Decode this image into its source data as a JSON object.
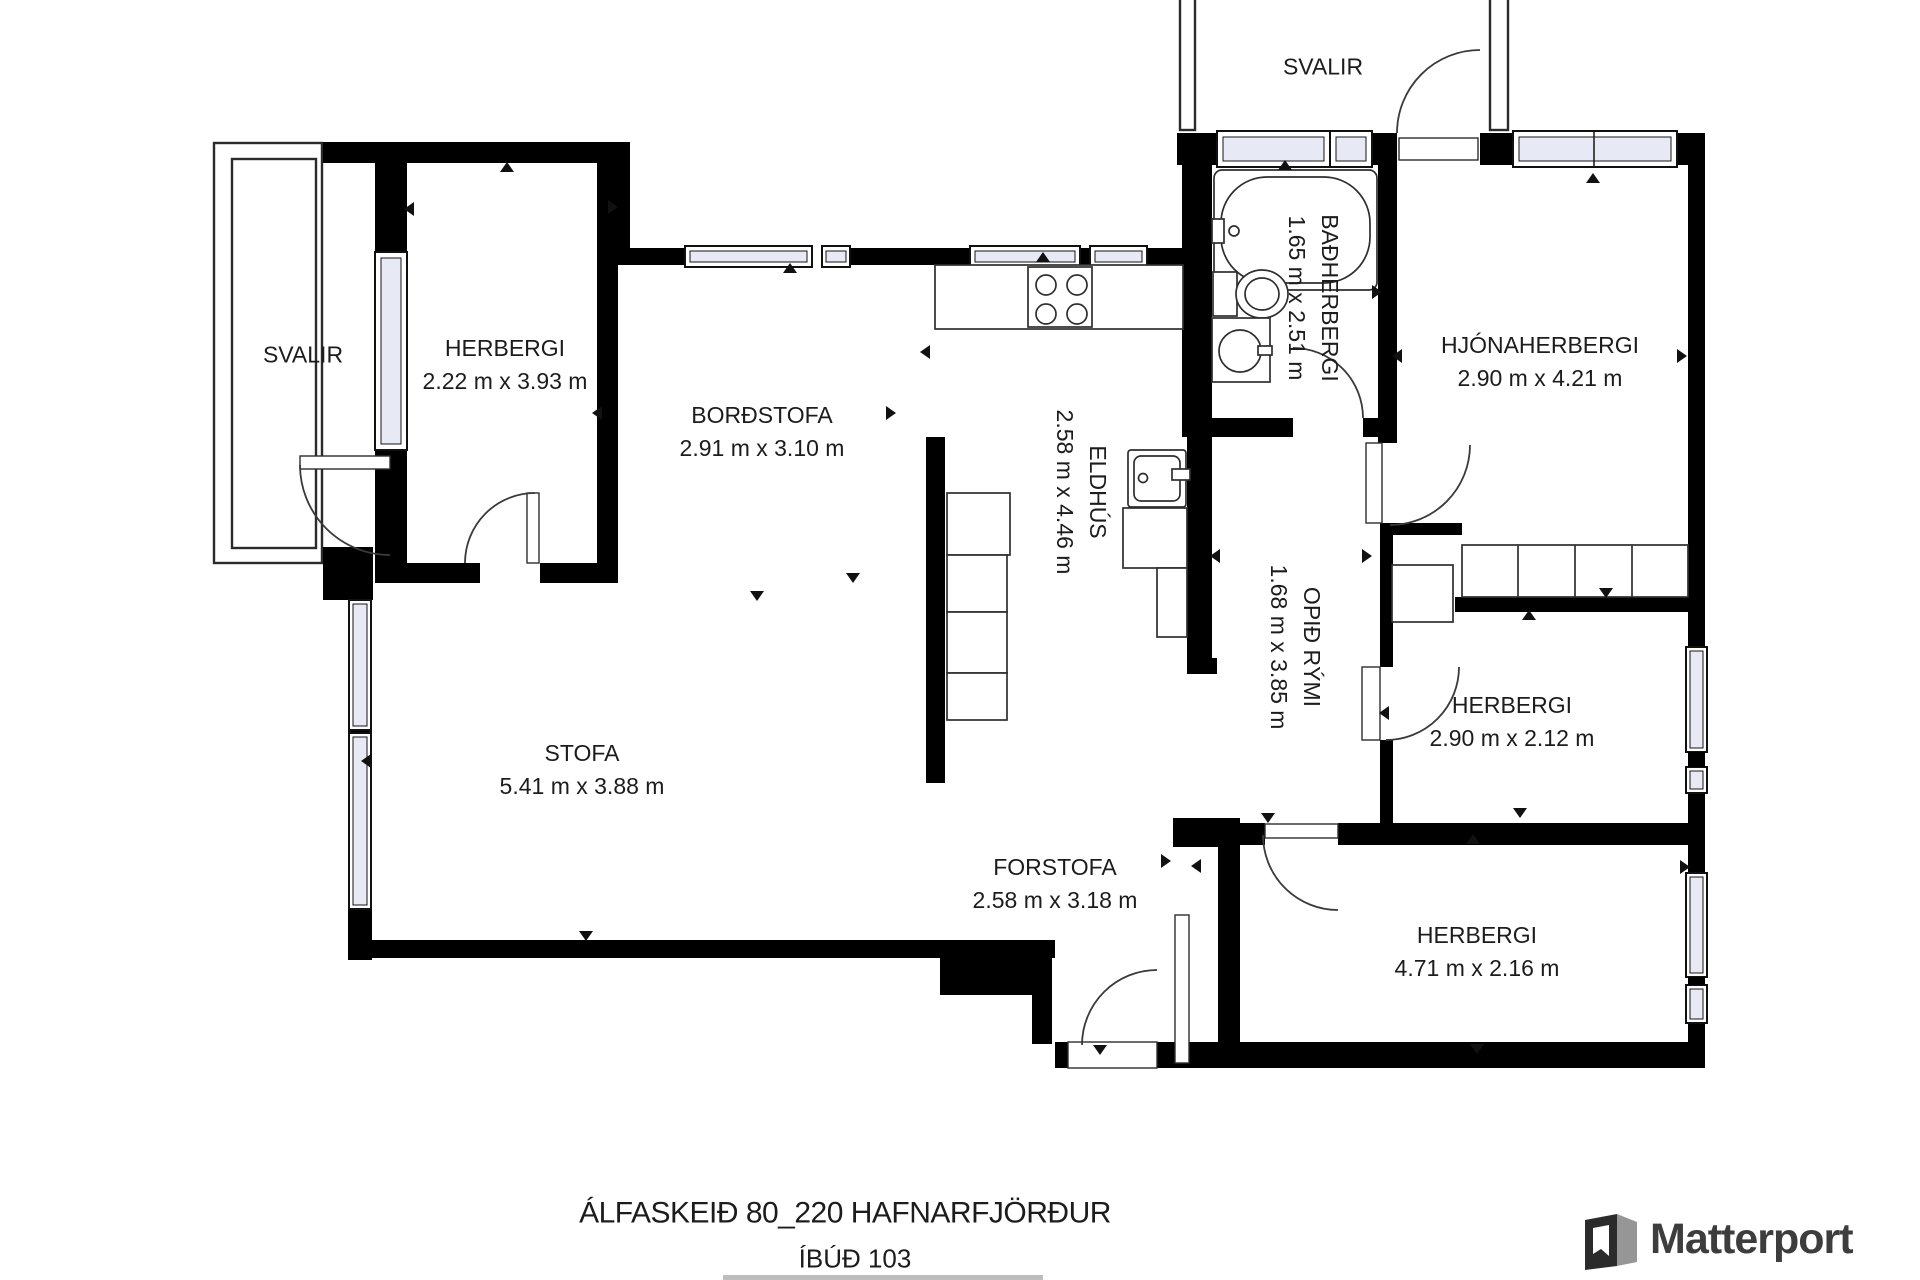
{
  "plan": {
    "address_line": "ÁLFASKEIÐ 80_220 HAFNARFJÖRÐUR",
    "unit_line": "ÍBÚÐ 103"
  },
  "branding": {
    "logo_text": "Matterport"
  },
  "rooms": {
    "svalir_top": {
      "name": "SVALIR"
    },
    "svalir_left": {
      "name": "SVALIR"
    },
    "herbergi_nw": {
      "name": "HERBERGI",
      "dims": "2.22 m x 3.93 m"
    },
    "bordstofa": {
      "name": "BORÐSTOFA",
      "dims": "2.91 m x 3.10 m"
    },
    "eldhus": {
      "name": "ELDHÚS",
      "dims": "2.58 m x 4.46 m"
    },
    "badherbergi": {
      "name": "BAÐHERBERGI",
      "dims": "1.65 m x 2.51 m"
    },
    "hjonaherbergi": {
      "name": "HJÓNAHERBERGI",
      "dims": "2.90 m x 4.21 m"
    },
    "opid_rymi": {
      "name": "OPIÐ RÝMI",
      "dims": "1.68 m x 3.85 m"
    },
    "herbergi_mid": {
      "name": "HERBERGI",
      "dims": "2.90 m x 2.12 m"
    },
    "stofa": {
      "name": "STOFA",
      "dims": "5.41 m x 3.88 m"
    },
    "forstofa": {
      "name": "FORSTOFA",
      "dims": "2.58 m x 3.18 m"
    },
    "herbergi_se": {
      "name": "HERBERGI",
      "dims": "4.71 m x 2.16 m"
    }
  },
  "colors": {
    "wall": "#000000",
    "glass": "#e7e9f4",
    "text": "#1c1c1c",
    "logo_text": "#3d3d3d",
    "logo_gray": "#969696"
  },
  "markers": [
    {
      "x": 613,
      "y": 207,
      "dir": "right"
    },
    {
      "x": 790,
      "y": 268,
      "dir": "up"
    },
    {
      "x": 1043,
      "y": 257,
      "dir": "up"
    },
    {
      "x": 597,
      "y": 413,
      "dir": "left"
    },
    {
      "x": 891,
      "y": 413,
      "dir": "right"
    },
    {
      "x": 507,
      "y": 167,
      "dir": "up"
    },
    {
      "x": 409,
      "y": 209,
      "dir": "left"
    },
    {
      "x": 757,
      "y": 596,
      "dir": "down"
    },
    {
      "x": 366,
      "y": 761,
      "dir": "left"
    },
    {
      "x": 586,
      "y": 936,
      "dir": "down"
    },
    {
      "x": 853,
      "y": 578,
      "dir": "down"
    },
    {
      "x": 925,
      "y": 352,
      "dir": "left"
    },
    {
      "x": 1100,
      "y": 1050,
      "dir": "down"
    },
    {
      "x": 1166,
      "y": 861,
      "dir": "right"
    },
    {
      "x": 1196,
      "y": 866,
      "dir": "left"
    },
    {
      "x": 1268,
      "y": 818,
      "dir": "down"
    },
    {
      "x": 1285,
      "y": 165,
      "dir": "up"
    },
    {
      "x": 1377,
      "y": 292,
      "dir": "right"
    },
    {
      "x": 1397,
      "y": 356,
      "dir": "left"
    },
    {
      "x": 1682,
      "y": 356,
      "dir": "right"
    },
    {
      "x": 1593,
      "y": 178,
      "dir": "up"
    },
    {
      "x": 1520,
      "y": 813,
      "dir": "down"
    },
    {
      "x": 1473,
      "y": 839,
      "dir": "up"
    },
    {
      "x": 1477,
      "y": 1049,
      "dir": "down"
    },
    {
      "x": 1685,
      "y": 867,
      "dir": "right"
    },
    {
      "x": 1606,
      "y": 593,
      "dir": "down"
    },
    {
      "x": 1529,
      "y": 615,
      "dir": "up"
    },
    {
      "x": 1215,
      "y": 556,
      "dir": "left"
    },
    {
      "x": 1367,
      "y": 556,
      "dir": "right"
    },
    {
      "x": 1384,
      "y": 713,
      "dir": "left"
    }
  ]
}
